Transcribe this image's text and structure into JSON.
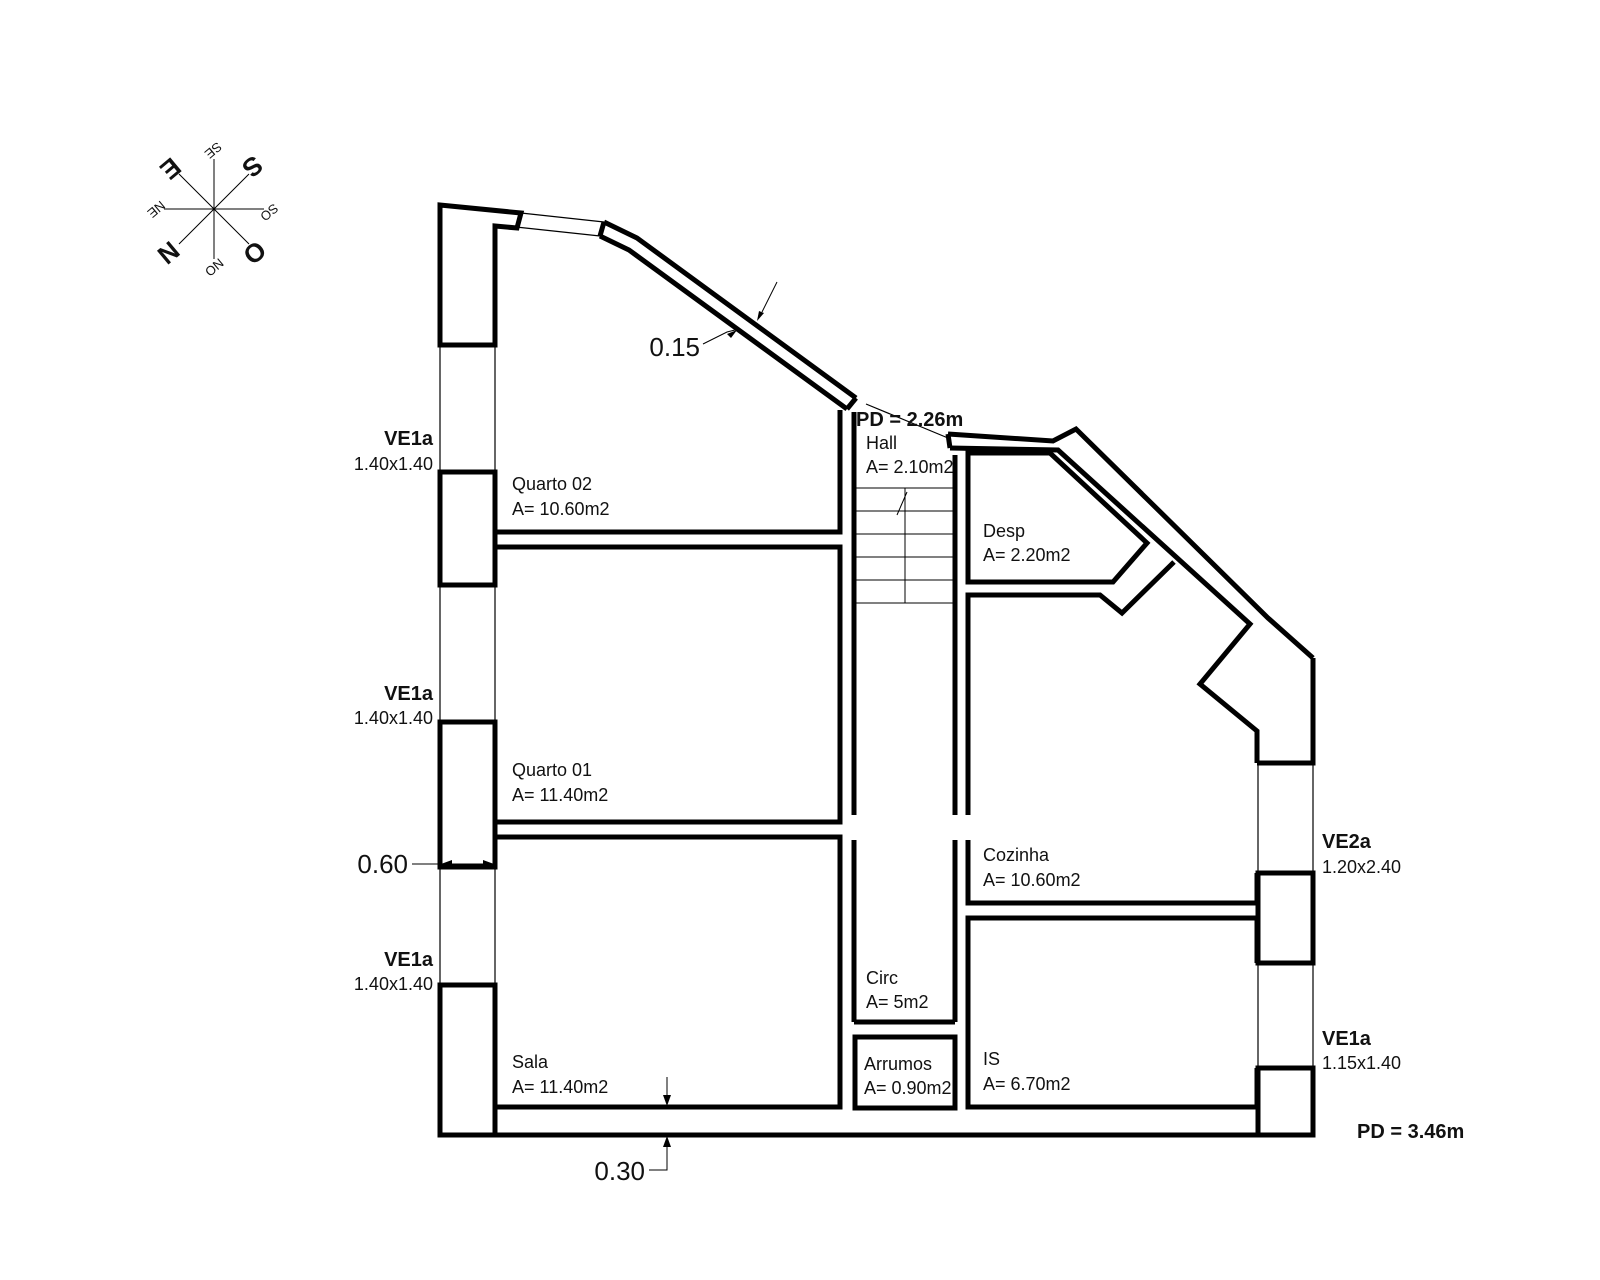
{
  "title": "Floor plan drawing",
  "colors": {
    "ink": "#000000",
    "dim_red": "#c0504d",
    "background": "#ffffff"
  },
  "rooms": {
    "quarto02": {
      "name": "Quarto 02",
      "area": "A= 10.60m2"
    },
    "quarto01": {
      "name": "Quarto 01",
      "area": "A= 11.40m2"
    },
    "sala": {
      "name": "Sala",
      "area": "A= 11.40m2"
    },
    "hall": {
      "name": "Hall",
      "area": "A= 2.10m2"
    },
    "circ": {
      "name": "Circ",
      "area": "A= 5m2"
    },
    "arrumos": {
      "name": "Arrumos",
      "area": "A= 0.90m2"
    },
    "desp": {
      "name": "Desp",
      "area": "A= 2.20m2"
    },
    "cozinha": {
      "name": "Cozinha",
      "area": "A= 10.60m2"
    },
    "is": {
      "name": "IS",
      "area": "A= 6.70m2"
    }
  },
  "windows": {
    "left1": {
      "label": "VE1a",
      "size": "1.40x1.40"
    },
    "left2": {
      "label": "VE1a",
      "size": "1.40x1.40"
    },
    "left3": {
      "label": "VE1a",
      "size": "1.40x1.40"
    },
    "right_top": {
      "label": "VE2a",
      "size": "1.20x2.40"
    },
    "right_bottom": {
      "label": "VE1a",
      "size": "1.15x1.40"
    }
  },
  "ceiling": {
    "upper": "PD = 2.26m",
    "lower": "PD = 3.46m"
  },
  "dimensions": {
    "diag_wall": "0.15",
    "left_wall": "0.60",
    "bottom_wall": "0.30"
  },
  "compass": {
    "n": "N",
    "s": "S",
    "e": "E",
    "o": "O",
    "ne": "NE",
    "se": "SE",
    "so": "SO",
    "no": "NO"
  }
}
